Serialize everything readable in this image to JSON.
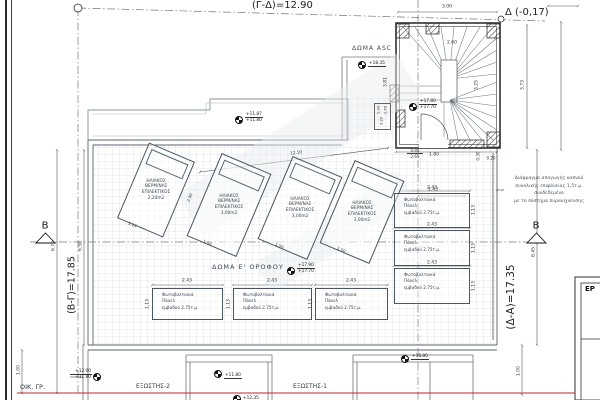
{
  "drawing": {
    "top_dimension": "(Γ-Δ)=12.90",
    "datum_ref": "Δ (-0,17)",
    "left_dimension": "(Β-Γ)=17.85",
    "right_dimension": "(Δ-Α)=17.35",
    "section_marker": "B",
    "building_line_label": "ΟΙΚ. ΓΡ."
  },
  "areas": {
    "roof_asc": "ΔΩΜΑ ASC",
    "roof_5th_floor": "ΔΩΜΑ Ε' ΟΡΟΦΟΥ",
    "balcony_1": "ΕΞΩΣΤΗΣ-1",
    "balcony_2": "ΕΞΩΣΤΗΣ-2"
  },
  "elevations": {
    "asc": "+18.35",
    "stair_upper": "+17.80",
    "stair_lower": "+17.70",
    "roof_upper": "+11.87",
    "roof_lower": "+11.80",
    "terrace_upper": "+17.90",
    "terrace_lower": "+17.70",
    "parapet": "+18.80",
    "left_upper": "+12.00",
    "left_lower": "+11.80",
    "balcony": "+11.80",
    "street": "+12.35"
  },
  "solar_panels": {
    "line1": "ΗΛΙΑΚΟΣ",
    "line2": "ΘΕΡΜ/ΝΑΣ",
    "line3": "ΕΠΙΛΕΚΤΙΚΟΣ",
    "areas": [
      "2,20m2",
      "3,00m2",
      "3,00m2",
      "3,00m2"
    ],
    "dim_width_small": "1.10",
    "dim_width": "1.50",
    "dim_height": "2.00"
  },
  "pv_panels": {
    "line1": "Φωτοβολταικά",
    "line2": "Πάνελ",
    "line3": "εμβαδού 2.75τ.μ.",
    "dim_width": "2.43",
    "dim_height": "1.13"
  },
  "note": {
    "line1": "Διάφραγμα απαγωγής καπνού",
    "line2": "συνολικής επιφάνειας 1,5τ.μ. συνδεδεμένο",
    "line3": "με το σύστημα πυρανίχνευσης"
  },
  "dims": {
    "stair_width": "3.00",
    "stair_inner": "2.60",
    "stair_left": "3.81",
    "stair_right": "3.73",
    "stair_mid": "3.25",
    "d085": "0.85",
    "d265": "2.65",
    "d180": "1.80",
    "d030": "0.30",
    "d020": "0.20",
    "d143": "1.43",
    "d670": "6.70",
    "d650": "6.50",
    "d645": "6.45",
    "d100": "1.00",
    "diag": "12.10",
    "box1": "1.30",
    "box2": "1.50",
    "box3": "3.20"
  },
  "title_block": {
    "partial_text": "ΕΡ"
  }
}
